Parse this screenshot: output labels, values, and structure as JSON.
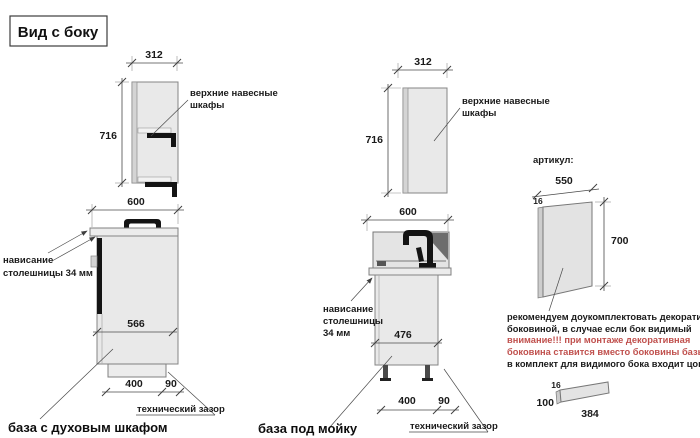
{
  "title": "Вид с боку",
  "colors": {
    "warning_red": "#c0504d",
    "cabinet_fill": "#e9e9e9",
    "accent_black": "#141414"
  },
  "left": {
    "wall": {
      "width": "312",
      "height": "716",
      "label_line1": "верхние навесные",
      "label_line2": "шкафы"
    },
    "base": {
      "width": "600",
      "inner": "566",
      "plinth": "400",
      "gap": "90",
      "overhang_line1": "нависание",
      "overhang_line2": "столешницы 34 мм",
      "tech_gap": "технический зазор",
      "caption": "база с духовым шкафом"
    }
  },
  "middle": {
    "wall": {
      "width": "312",
      "height": "716",
      "label_line1": "верхние навесные",
      "label_line2": "шкафы"
    },
    "base": {
      "width": "600",
      "inner": "476",
      "plinth": "400",
      "gap": "90",
      "overhang_line1": "нависание",
      "overhang_line2": "столешницы",
      "overhang_line3": "34 мм",
      "tech_gap": "технический зазор",
      "caption": "база под мойку"
    }
  },
  "right": {
    "artikul": "артикул:",
    "panel": {
      "width": "550",
      "thickness": "16",
      "height": "700"
    },
    "note_line1": "рекомендуем доукомплектовать декоративной",
    "note_line2": "боковиной, в случае если бок видимый",
    "note_line3": "внимание!!! при монтаже декоративная",
    "note_line4": "боковина ставится вместо боковины базы лдсп",
    "note_line5": "в комплект для видимого бока входит цоколь:",
    "plinth": {
      "thickness": "16",
      "height": "100",
      "length": "384"
    }
  }
}
